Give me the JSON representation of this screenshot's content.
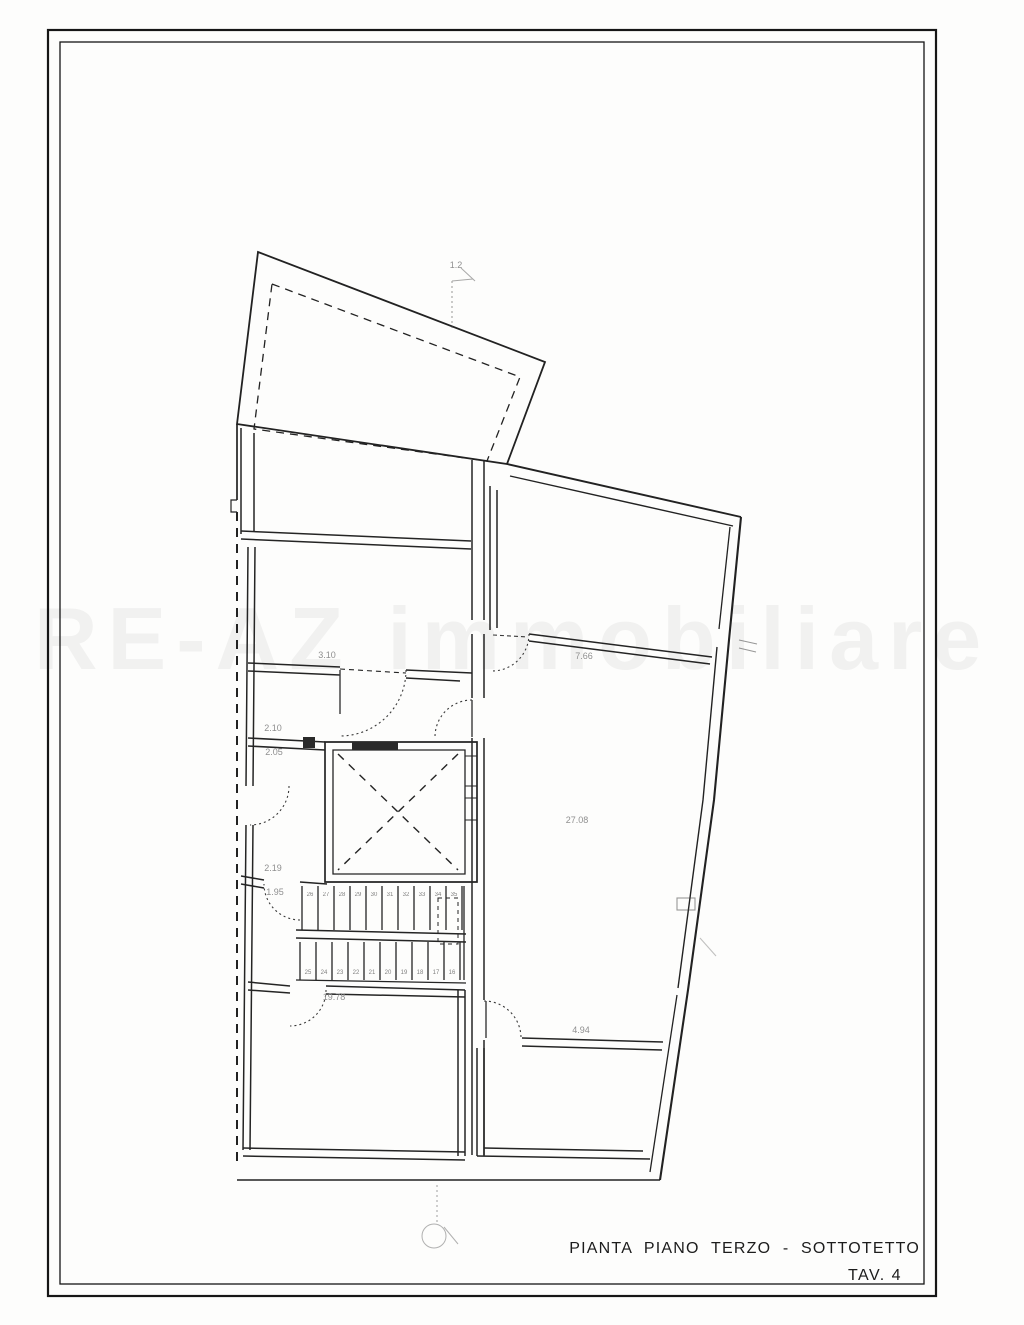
{
  "titleblock": {
    "line1": "PIANTA PIANO TERZO - SOTTOTETTO",
    "line2": "TAV. 4"
  },
  "watermark": {
    "text": "RE-AZ immobiliare"
  },
  "plan": {
    "type": "architectural-floor-plan",
    "floor": "piano terzo / sottotetto",
    "labels": {
      "section_top": "1.2",
      "room_b_dim": "3.10",
      "corr_dim_1": "2.10",
      "corr_dim_2": "2.05",
      "hall_dim_1": "2.19",
      "hall_dim_2": "1.95",
      "right_top_dim": "7.66",
      "living_area": "27.08",
      "room_sw_area": "19.78",
      "room_se_dim": "4.94"
    },
    "stairs": {
      "upper": [
        "26",
        "27",
        "28",
        "29",
        "30",
        "31",
        "32",
        "33",
        "34",
        "35"
      ],
      "lower": [
        "16",
        "17",
        "18",
        "19",
        "20",
        "21",
        "22",
        "23",
        "24",
        "25"
      ]
    }
  }
}
